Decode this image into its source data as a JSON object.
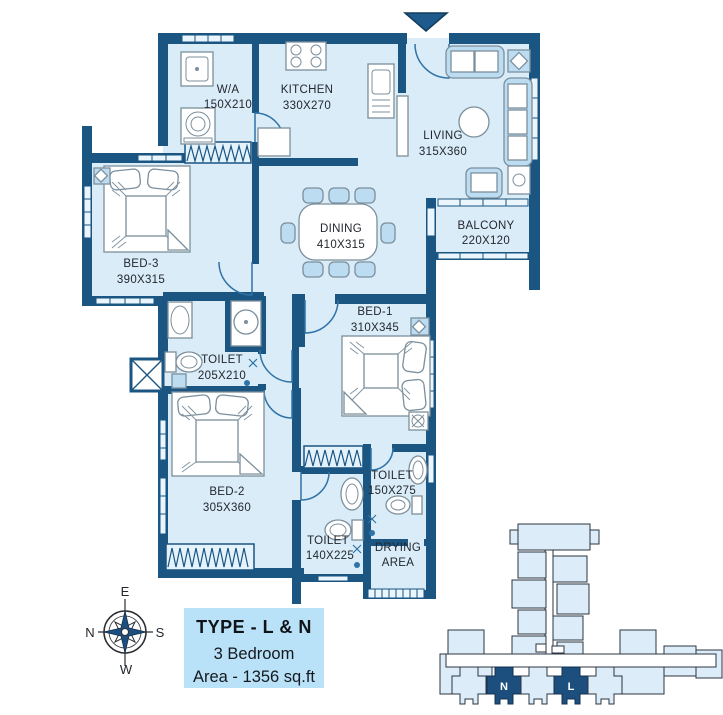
{
  "plan": {
    "rooms": {
      "wa": {
        "name": "W/A",
        "dims": "150X210"
      },
      "kitchen": {
        "name": "KITCHEN",
        "dims": "330X270"
      },
      "living": {
        "name": "LIVING",
        "dims": "315X360"
      },
      "balcony": {
        "name": "BALCONY",
        "dims": "220X120"
      },
      "bed3": {
        "name": "BED-3",
        "dims": "390X315"
      },
      "dining": {
        "name": "DINING",
        "dims": "410X315"
      },
      "toilet1": {
        "name": "TOILET",
        "dims": "205X210"
      },
      "bed1": {
        "name": "BED-1",
        "dims": "310X345"
      },
      "bed2": {
        "name": "BED-2",
        "dims": "305X360"
      },
      "toilet2": {
        "name": "TOILET",
        "dims": "140X225"
      },
      "toilet3": {
        "name": "TOILET",
        "dims": "150X275"
      },
      "drying": {
        "line1": "DRYING",
        "line2": "AREA"
      }
    }
  },
  "compass": {
    "east": "E",
    "south": "S",
    "west": "W",
    "north": "N"
  },
  "legend": {
    "title": "TYPE - L & N",
    "bedrooms": "3 Bedroom",
    "area": "Area - 1356 sq.ft"
  },
  "keyplan": {
    "unit_n": "N",
    "unit_l": "L"
  },
  "colors": {
    "wall": "#1b5581",
    "floor": "#d9ecf8",
    "furniture_accent": "#bcdcf2",
    "legend_bg": "#b9e2f8",
    "keyplan_unit": "#dcecf8",
    "keyplan_highlight": "#1d4f7e"
  }
}
